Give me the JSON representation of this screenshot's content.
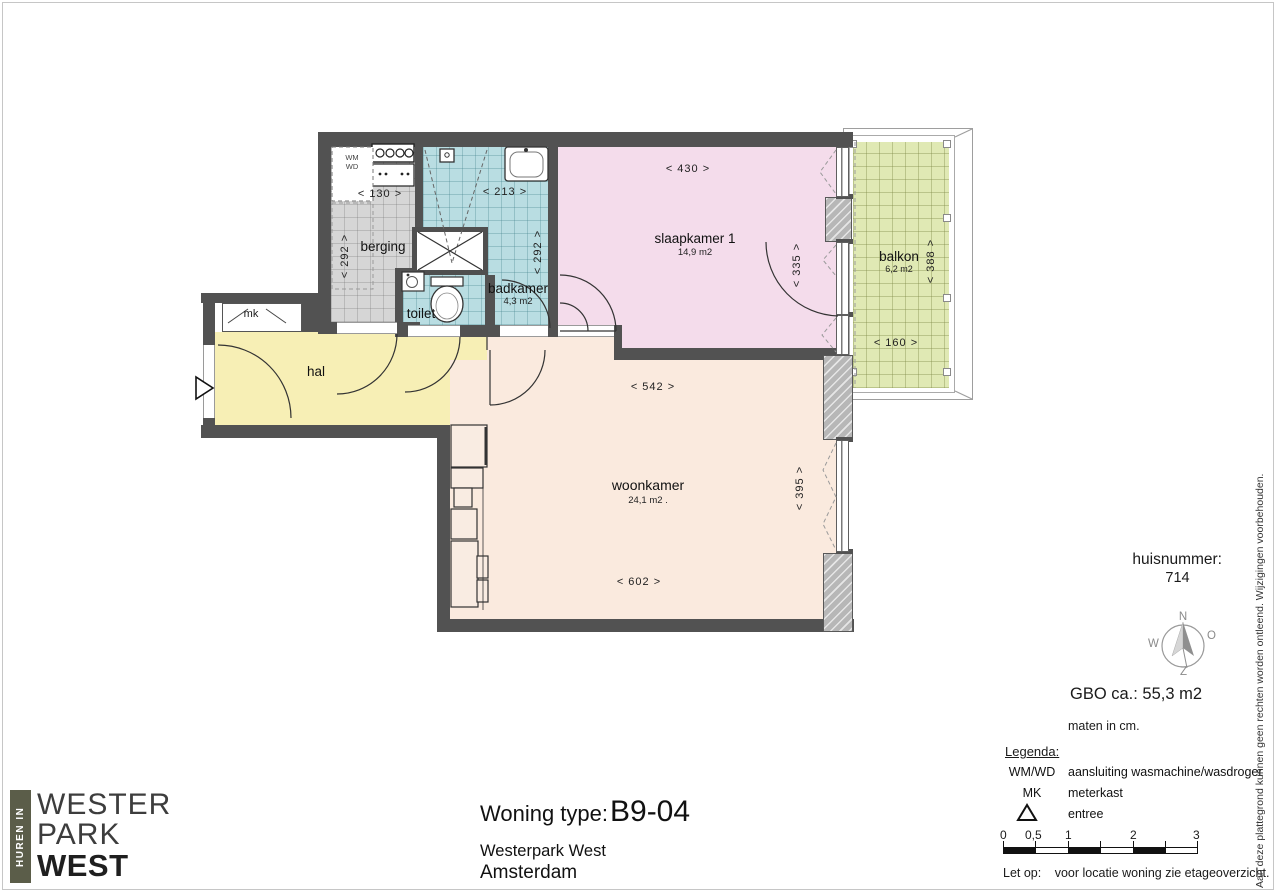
{
  "colors": {
    "wall": "#525252",
    "hal": "#f7efb5",
    "slaapkamer": "#f4dceb",
    "woonkamer": "#faeade",
    "badkamer": "#b9dde2",
    "berging": "#d6d6d6",
    "balkon": "#e0e9b4",
    "logo_bar": "#5b5d49"
  },
  "plan": {
    "rooms": [
      {
        "name": "berging",
        "area": ""
      },
      {
        "name": "badkamer",
        "area": "4,3 m2"
      },
      {
        "name": "toilet",
        "area": ""
      },
      {
        "name": "hal",
        "area": ""
      },
      {
        "name": "slaapkamer 1",
        "area": "14,9 m2"
      },
      {
        "name": "woonkamer",
        "area": "24,1 m2 ."
      },
      {
        "name": "balkon",
        "area": "6,2 m2"
      },
      {
        "name": "mk",
        "area": ""
      }
    ],
    "appliances": {
      "wm": "WM",
      "wd": "WD"
    },
    "dims": {
      "w130": "< 130 >",
      "w213": "< 213 >",
      "w430": "< 430 >",
      "h292a": "< 292 >",
      "h292b": "< 292 >",
      "h335": "< 335 >",
      "h388": "< 388 >",
      "w160": "< 160 >",
      "w542": "< 542 >",
      "h395": "< 395 >",
      "w602": "< 602 >"
    }
  },
  "info": {
    "huisnummer_label": "huisnummer:",
    "huisnummer": "714",
    "gbo": "GBO ca.:  55,3 m2",
    "maten": "maten in cm."
  },
  "compass": {
    "n": "N",
    "o": "O",
    "z": "Z",
    "w": "W"
  },
  "legend": {
    "title": "Legenda:",
    "rows": [
      {
        "key": "WM/WD",
        "desc": "aansluiting wasmachine/wasdroger"
      },
      {
        "key": "MK",
        "desc": "meterkast"
      },
      {
        "key": "",
        "desc": "entree"
      }
    ]
  },
  "scalebar": {
    "labels": [
      "0",
      "0,5",
      "1",
      "2",
      "3"
    ]
  },
  "note": {
    "label": "Let op:",
    "text": "voor locatie woning zie etageoverzicht."
  },
  "titleblock": {
    "label": "Woning type:",
    "type": "B9-04",
    "project": "Westerpark West",
    "city": "Amsterdam"
  },
  "logo": {
    "vertical": "HUREN IN",
    "line1": "WESTER",
    "line2": "PARK",
    "line3": "WEST"
  },
  "disclaimer": "Aan deze plattegrond kunnen geen rechten worden ontleend. Wijzigingen voorbehouden."
}
